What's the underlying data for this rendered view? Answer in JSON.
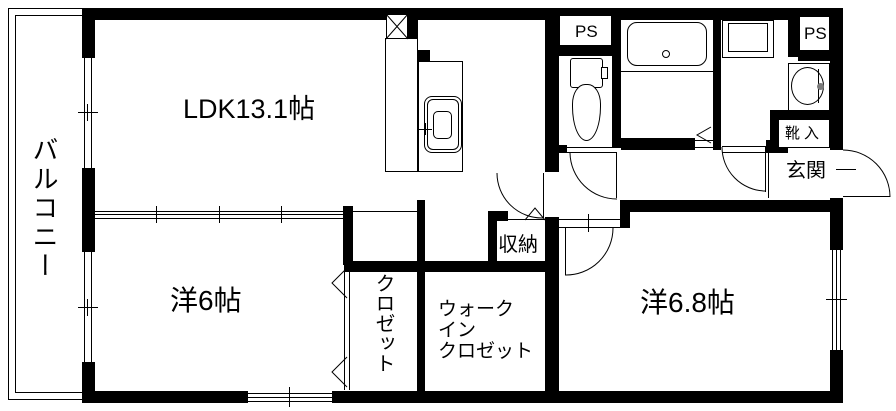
{
  "floorplan": {
    "rooms": {
      "balcony": {
        "label": "バルコニー"
      },
      "ldk": {
        "label": "LDK13.1帖"
      },
      "bedroom1": {
        "label": "洋6帖"
      },
      "bedroom2": {
        "label": "洋6.8帖"
      },
      "closet": {
        "label": "クロゼット"
      },
      "walkin_closet": {
        "line1": "ウォーク",
        "line2": "イン",
        "line3": "クロゼット"
      },
      "storage": {
        "label": "収納"
      },
      "entrance": {
        "label": "玄関"
      },
      "shoe_box": {
        "label": "靴入"
      },
      "pipe_space_top": {
        "label": "PS"
      },
      "pipe_space_right": {
        "label": "PS"
      }
    },
    "colors": {
      "wall": "#000000",
      "background": "#ffffff",
      "faucet_dot": "#7a7a7a"
    }
  }
}
